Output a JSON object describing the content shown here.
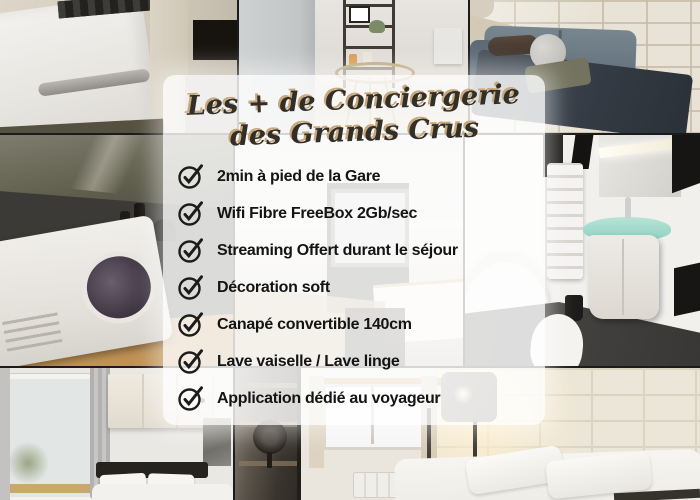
{
  "card": {
    "title_line1": "Les + de Conciergerie",
    "title_line2": "des Grands Crus",
    "items": [
      {
        "icon": "check-circle-icon",
        "label": "2min à pied de la Gare"
      },
      {
        "icon": "check-circle-icon",
        "label": "Wifi Fibre FreeBox 2Gb/sec"
      },
      {
        "icon": "check-circle-icon",
        "label": "Streaming Offert durant le séjour"
      },
      {
        "icon": "check-circle-icon",
        "label": "Décoration soft"
      },
      {
        "icon": "check-circle-icon",
        "label": "Canapé convertible 140cm"
      },
      {
        "icon": "check-circle-icon",
        "label": "Lave vaiselle / Lave linge"
      },
      {
        "icon": "check-circle-icon",
        "label": "Application dédié au voyageur"
      }
    ],
    "colors": {
      "card_bg": "rgba(255,255,255,0.82)",
      "title": "#322e28",
      "title_shadow": "#c8a87c",
      "item_text": "#141414",
      "check": "#1c1c1c"
    }
  },
  "collage": {
    "photos": [
      {
        "name": "washing-machine-photo"
      },
      {
        "name": "side-table-decor-photo"
      },
      {
        "name": "living-room-sofa-photo"
      },
      {
        "name": "kitchen-microwave-photo"
      },
      {
        "name": "kitchen-counter-photo"
      },
      {
        "name": "bathroom-photo"
      },
      {
        "name": "bedroom-window-photo"
      },
      {
        "name": "bedroom-brick-wall-photo"
      }
    ]
  }
}
